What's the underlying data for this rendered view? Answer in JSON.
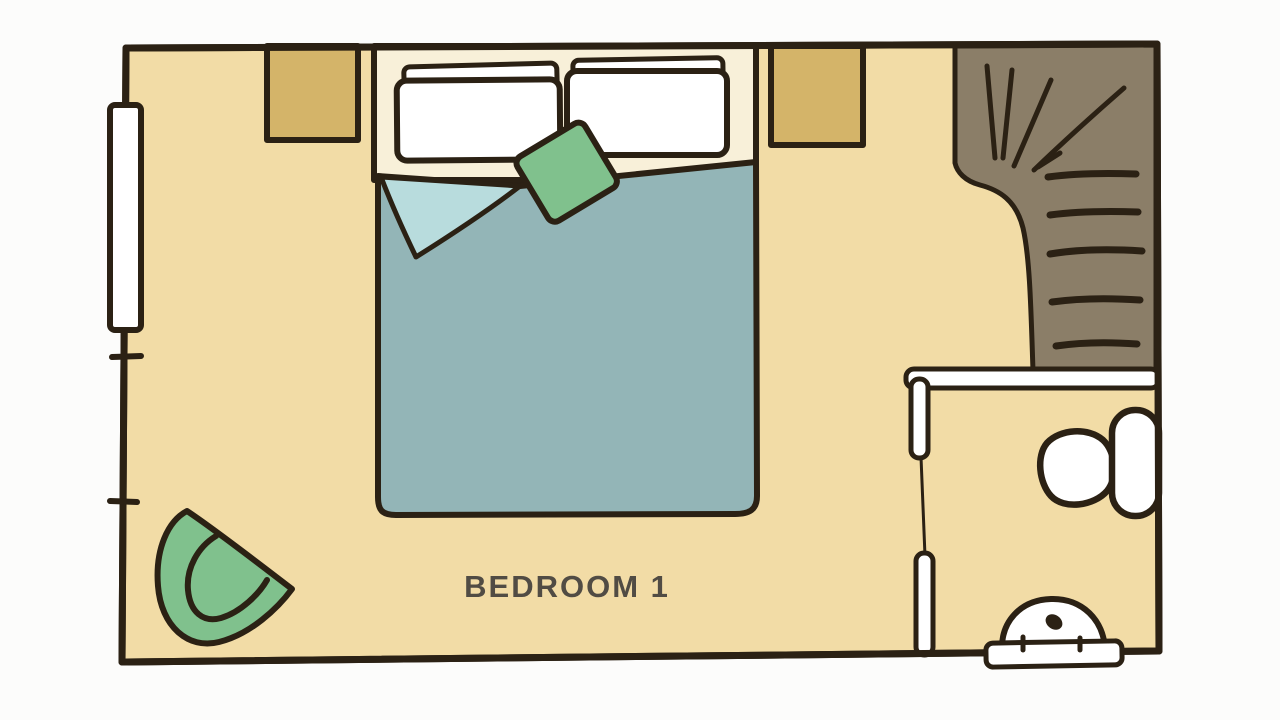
{
  "room": {
    "label": "BEDROOM 1"
  },
  "colors": {
    "background": "#fcfcfb",
    "outline": "#2b2114",
    "floor": "#f2dca6",
    "bed_base": "#f8f0d9",
    "pillow": "#ffffff",
    "duvet": "#93b5b7",
    "sheet_fold": "#b8dcdd",
    "accent_green": "#80c18d",
    "nightstand": "#d4b469",
    "stairs": "#8b7e68",
    "fixture_white": "#ffffff",
    "label_text": "#514c44"
  }
}
